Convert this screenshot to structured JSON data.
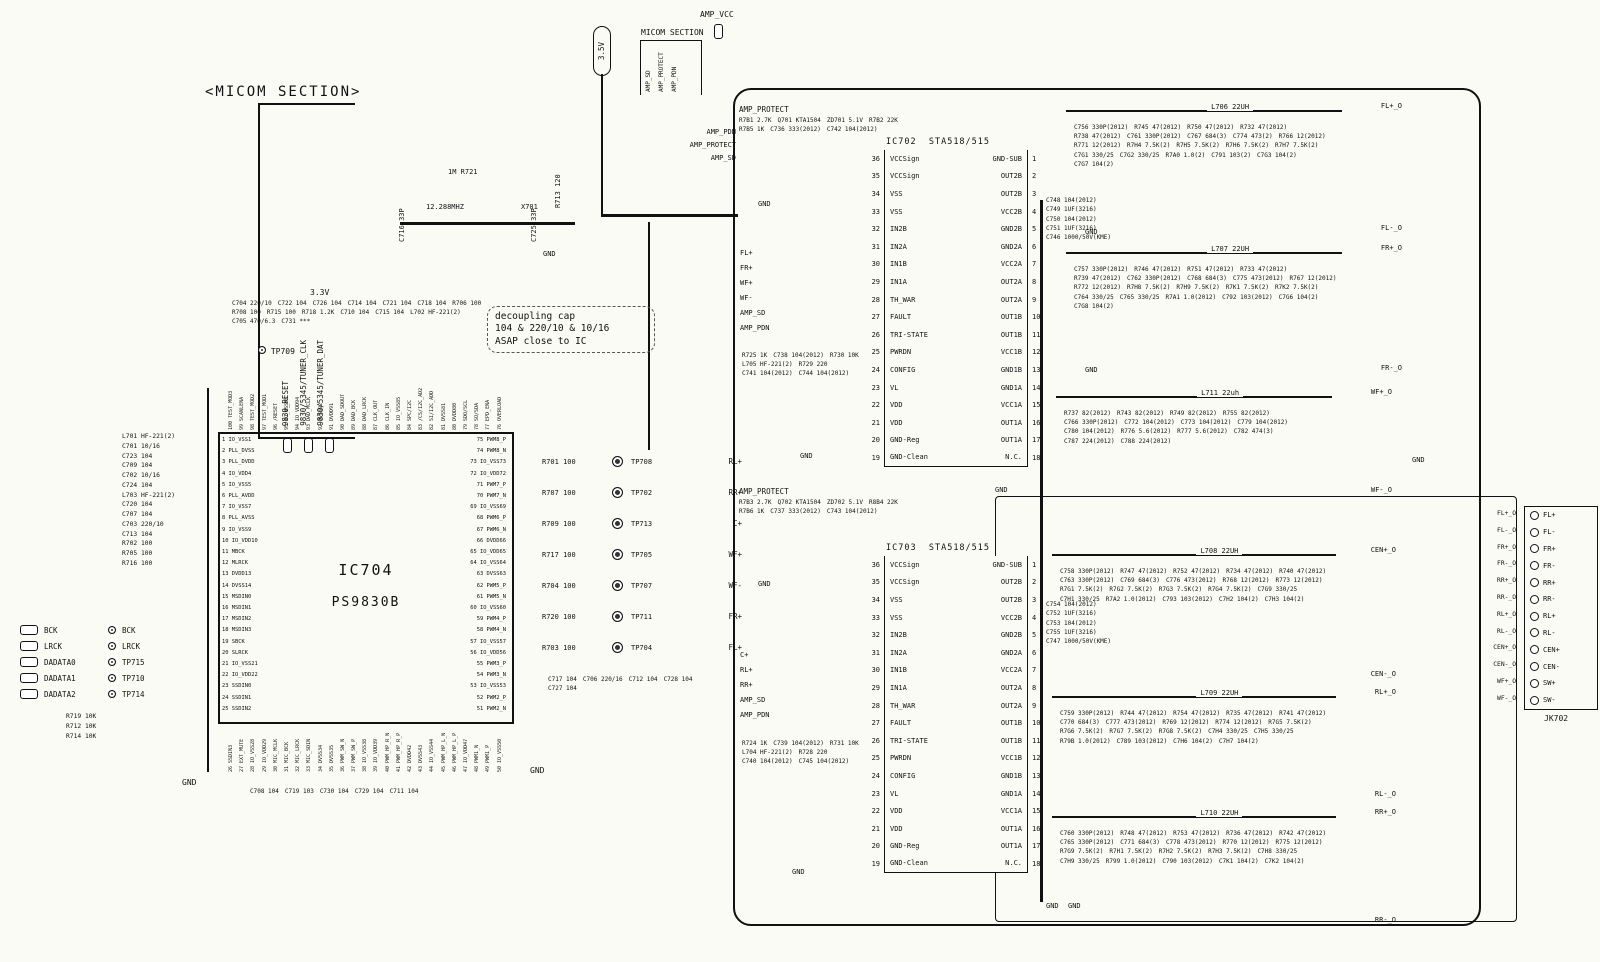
{
  "labels": {
    "gnd": "GND",
    "v35": "3.5V",
    "v33": "3.3V",
    "amp_vcc": "AMP_VCC",
    "tp709": "TP709"
  },
  "micom_section": {
    "title": "<MICOM SECTION>",
    "signals": [
      "9830_RESET",
      "9830/5345/TUNER_CLK",
      "9830/5345/TUNER_DAT"
    ]
  },
  "micom2": {
    "title": "MICOM SECTION",
    "signals": [
      "AMP_SD",
      "AMP_PROTECT",
      "AMP_PDN"
    ]
  },
  "amp_entry": [
    "AMP_PDN",
    "AMP_PROTECT",
    "AMP_SD"
  ],
  "crystal": {
    "r721": "1M R721",
    "freq": "12.288MHZ",
    "x701": "X701",
    "c716": "C716 33P",
    "c725": "C725 33P",
    "r713": "R713 120",
    "gnd": "GND"
  },
  "note": {
    "lines": [
      "decoupling cap",
      "104 & 220/10 & 10/16",
      "ASAP close to IC"
    ]
  },
  "ic704": {
    "ref": "IC704",
    "part": "PS9830B",
    "left": [
      "1 IO_VSS1",
      "2 PLL_DVSS",
      "3 PLL_DVDD",
      "4 IO_VDD4",
      "5 IO_VSS5",
      "6 PLL_AVDD",
      "7 IO_VSS7",
      "8 PLL_AVSS",
      "9 IO_VSS9",
      "10 IO_VDD10",
      "11 MBCK",
      "12 MLRCK",
      "13 DVDD13",
      "14 DVSS14",
      "15 MSDIN0",
      "16 MSDIN1",
      "17 MSDIN2",
      "18 MSDIN3",
      "19 SBCK",
      "20 SLRCK",
      "21 IO_VSS21",
      "22 IO_VDD22",
      "23 SSDIN0",
      "24 SSDIN1",
      "25 SSDIN2"
    ],
    "right": [
      "75 PWM8_P",
      "74 PWM8_N",
      "73 IO_VSS73",
      "72 IO_VDD72",
      "71 PWM7_P",
      "70 PWM7_N",
      "69 IO_VSS69",
      "68 PWM6_P",
      "67 PWM6_N",
      "66 DVDD66",
      "65 IO_VDD65",
      "64 IO_VSS64",
      "63 DVSS63",
      "62 PWM5_P",
      "61 PWM5_N",
      "60 IO_VSS60",
      "59 PWM4_P",
      "58 PWM4_N",
      "57 IO_VSS57",
      "56 IO_VDD56",
      "55 PWM3_P",
      "54 PWM3_N",
      "53 IO_VSS53",
      "52 PWM2_P",
      "51 PWM2_N"
    ],
    "top": [
      "100 TEST_MOD3",
      "99 SCANLENA",
      "98 TEST_MOD2",
      "97 TEST_MOD1",
      "96 /RESET",
      "95 IO_VSS95",
      "94 IO_VDD94",
      "93 DAD_MCLK",
      "92 DVSS92",
      "91 DVDD91",
      "90 DAD_SDOUT",
      "89 DAD_BCK",
      "88 DAD_LRCK",
      "87 CLK_OUT",
      "86 CLK_IN",
      "85 IO_VSS85",
      "84 SPC/I2C",
      "83 /CS/I2C_AD2",
      "82 SI/I2C_ADD",
      "81 DVSS81",
      "80 DVDD80",
      "79 SDO/SCL",
      "78 SO/SDA",
      "77 EPD_ENA",
      "76 OVERLOAD"
    ],
    "bottom": [
      "26 SSDIN3",
      "27 EXT_MUTE",
      "28 IO_VSS28",
      "29 IO_VDD29",
      "30 MIC_MCLK",
      "31 MIC_BCK",
      "32 MIC_LRCK",
      "33 MIC_SDIN",
      "34 DVSS34",
      "35 DVSS35",
      "36 PWM_SW_N",
      "37 PWM_SW_P",
      "38 IO_VSS38",
      "39 IO_VDD39",
      "40 PWM_HP_R_N",
      "41 PWM_HP_R_P",
      "42 DVDD42",
      "43 DVSS43",
      "44 IO_VSS44",
      "45 PWM_HP_L_N",
      "46 PWM_HP_L_P",
      "47 IO_VDD47",
      "48 PWM1_N",
      "49 PWM1_P",
      "50 IO_VSS50"
    ],
    "left_parts": [
      "L701 HF-221(2)",
      "C701 10/16",
      "C723 104",
      "C709 104",
      "C702 10/16",
      "C724 104",
      "L703 HF-221(2)",
      "C720 104",
      "C707 104",
      "C703 220/10",
      "C713 104",
      "R702 100",
      "R705 100",
      "R716 100"
    ],
    "top_parts": [
      "C704 220/10",
      "C722 104",
      "C726 104",
      "C714 104",
      "C721 104",
      "C718 104",
      "R706 100",
      "R708 100",
      "R715 100",
      "R718 1.2K",
      "C710 104",
      "C715 104",
      "L702 HF-221(2)",
      "C705 470/6.3",
      "C731 ***"
    ],
    "bottom_parts": [
      "C708 104",
      "C719 103",
      "C730 104",
      "C729 104",
      "C711 104"
    ]
  },
  "conn_left": {
    "rows": [
      {
        "pad": "BCK",
        "tp": "BCK"
      },
      {
        "pad": "LRCK",
        "tp": "LRCK"
      },
      {
        "pad": "DADATA0",
        "tp": "TP715"
      },
      {
        "pad": "DADATA1",
        "tp": "TP710"
      },
      {
        "pad": "DADATA2",
        "tp": "TP714"
      }
    ],
    "pulls": [
      "R719 10K",
      "R712 10K",
      "R714 10K"
    ]
  },
  "tp": {
    "rows": [
      {
        "res": "R701 100",
        "tp": "TP708",
        "sig": "RL+"
      },
      {
        "res": "R707 100",
        "tp": "TP702",
        "sig": "RR+"
      },
      {
        "res": "R709 100",
        "tp": "TP713",
        "sig": "C+"
      },
      {
        "res": "R717 100",
        "tp": "TP705",
        "sig": "WF+"
      },
      {
        "res": "R704 100",
        "tp": "TP707",
        "sig": "WF-"
      },
      {
        "res": "R720 100",
        "tp": "TP711",
        "sig": "FR+"
      },
      {
        "res": "R703 100",
        "tp": "TP704",
        "sig": "FL+"
      }
    ],
    "caps": [
      "C717 104",
      "C706 220/16",
      "C712 104",
      "C728 104",
      "C727 104"
    ]
  },
  "prot1": {
    "entry": "AMP_PROTECT",
    "parts": [
      "R7B1 2.7K",
      "Q701 KTA1504",
      "ZD701 5.1V",
      "R7B2 22K",
      "R7B5 1K",
      "C736 333(2012)",
      "C742 104(2012)"
    ]
  },
  "prot2": {
    "entry": "AMP_PROTECT",
    "parts": [
      "R7B3 2.7K",
      "Q702 KTA1504",
      "ZD702 5.1V",
      "R8B4 22K",
      "R7B6 1K",
      "C737 333(2012)",
      "C743 104(2012)"
    ]
  },
  "ic702": {
    "ref": "IC702",
    "part": "STA518/515",
    "rows": [
      {
        "nl": 36,
        "ll": "VCCSign",
        "lr": "GND-SUB",
        "nr": 1
      },
      {
        "nl": 35,
        "ll": "VCCSign",
        "lr": "OUT2B",
        "nr": 2
      },
      {
        "nl": 34,
        "ll": "VSS",
        "lr": "OUT2B",
        "nr": 3
      },
      {
        "nl": 33,
        "ll": "VSS",
        "lr": "VCC2B",
        "nr": 4
      },
      {
        "nl": 32,
        "ll": "IN2B",
        "lr": "GND2B",
        "nr": 5
      },
      {
        "nl": 31,
        "ll": "IN2A",
        "lr": "GND2A",
        "nr": 6
      },
      {
        "nl": 30,
        "ll": "IN1B",
        "lr": "VCC2A",
        "nr": 7
      },
      {
        "nl": 29,
        "ll": "IN1A",
        "lr": "OUT2A",
        "nr": 8
      },
      {
        "nl": 28,
        "ll": "TH_WAR",
        "lr": "OUT2A",
        "nr": 9
      },
      {
        "nl": 27,
        "ll": "FAULT",
        "lr": "OUT1B",
        "nr": 10
      },
      {
        "nl": 26,
        "ll": "TRI-STATE",
        "lr": "OUT1B",
        "nr": 11
      },
      {
        "nl": 25,
        "ll": "PWRDN",
        "lr": "VCC1B",
        "nr": 12
      },
      {
        "nl": 24,
        "ll": "CONFIG",
        "lr": "GND1B",
        "nr": 13
      },
      {
        "nl": 23,
        "ll": "VL",
        "lr": "GND1A",
        "nr": 14
      },
      {
        "nl": 22,
        "ll": "VDD",
        "lr": "VCC1A",
        "nr": 15
      },
      {
        "nl": 21,
        "ll": "VDD",
        "lr": "OUT1A",
        "nr": 16
      },
      {
        "nl": 20,
        "ll": "GND-Reg",
        "lr": "OUT1A",
        "nr": 17
      },
      {
        "nl": 19,
        "ll": "GND-Clean",
        "lr": "N.C.",
        "nr": 18
      }
    ],
    "caps": [
      "C748 104(2012)",
      "C749 1UF(3216)",
      "C750 104(2012)",
      "C751 1UF(3216)",
      "C746 1000/50V(KME)"
    ]
  },
  "ic703": {
    "ref": "IC703",
    "part": "STA518/515",
    "rows": [
      {
        "nl": 36,
        "ll": "VCCSign",
        "lr": "GND-SUB",
        "nr": 1
      },
      {
        "nl": 35,
        "ll": "VCCSign",
        "lr": "OUT2B",
        "nr": 2
      },
      {
        "nl": 34,
        "ll": "VSS",
        "lr": "OUT2B",
        "nr": 3
      },
      {
        "nl": 33,
        "ll": "VSS",
        "lr": "VCC2B",
        "nr": 4
      },
      {
        "nl": 32,
        "ll": "IN2B",
        "lr": "GND2B",
        "nr": 5
      },
      {
        "nl": 31,
        "ll": "IN2A",
        "lr": "GND2A",
        "nr": 6
      },
      {
        "nl": 30,
        "ll": "IN1B",
        "lr": "VCC2A",
        "nr": 7
      },
      {
        "nl": 29,
        "ll": "IN1A",
        "lr": "OUT2A",
        "nr": 8
      },
      {
        "nl": 28,
        "ll": "TH_WAR",
        "lr": "OUT2A",
        "nr": 9
      },
      {
        "nl": 27,
        "ll": "FAULT",
        "lr": "OUT1B",
        "nr": 10
      },
      {
        "nl": 26,
        "ll": "TRI-STATE",
        "lr": "OUT1B",
        "nr": 11
      },
      {
        "nl": 25,
        "ll": "PWRDN",
        "lr": "VCC1B",
        "nr": 12
      },
      {
        "nl": 24,
        "ll": "CONFIG",
        "lr": "GND1B",
        "nr": 13
      },
      {
        "nl": 23,
        "ll": "VL",
        "lr": "GND1A",
        "nr": 14
      },
      {
        "nl": 22,
        "ll": "VDD",
        "lr": "VCC1A",
        "nr": 15
      },
      {
        "nl": 21,
        "ll": "VDD",
        "lr": "OUT1A",
        "nr": 16
      },
      {
        "nl": 20,
        "ll": "GND-Reg",
        "lr": "OUT1A",
        "nr": 17
      },
      {
        "nl": 19,
        "ll": "GND-Clean",
        "lr": "N.C.",
        "nr": 18
      }
    ],
    "caps": [
      "C754 104(2012)",
      "C752 1UF(3216)",
      "C753 104(2012)",
      "C755 1UF(3216)",
      "C747 1000/50V(KME)"
    ]
  },
  "ic702_in": {
    "signals": [
      "FL+",
      "FR+",
      "WF+",
      "WF-",
      "AMP_SD",
      "AMP_PDN"
    ],
    "parts": [
      "R725 1K",
      "C738 104(2012)",
      "R730 10K",
      "L705 HF-221(2)",
      "R729 220",
      "C741 104(2012)",
      "C744 104(2012)"
    ]
  },
  "ic703_in": {
    "signals": [
      "C+",
      "RL+",
      "RR+",
      "AMP_SD",
      "AMP_PDN"
    ],
    "parts": [
      "R724 1K",
      "C739 104(2012)",
      "R731 10K",
      "L704 HF-221(2)",
      "R728 220",
      "C740 104(2012)",
      "C745 104(2012)"
    ]
  },
  "channels": {
    "fl": {
      "ind": "L706 22UH",
      "out_p": "FL+_O",
      "out_n": "FL-_O",
      "parts": [
        "C756 330P(2012)",
        "R745 47(2012)",
        "R750 47(2012)",
        "R732 47(2012)",
        "R738 47(2012)",
        "C761 330P(2012)",
        "C767 684(3)",
        "C774 473(2)",
        "R766 12(2012)",
        "R771 12(2012)",
        "R7H4 7.5K(2)",
        "R7H5 7.5K(2)",
        "R7H6 7.5K(2)",
        "R7H7 7.5K(2)",
        "C7G1 330/25",
        "C7G2 330/25",
        "R7A0 1.0(2)",
        "C791 103(2)",
        "C7G3 104(2)",
        "C7G7 104(2)"
      ]
    },
    "fr": {
      "ind": "L707 22UH",
      "out_p": "FR+_O",
      "out_n": "FR-_O",
      "parts": [
        "C757 330P(2012)",
        "R746 47(2012)",
        "R751 47(2012)",
        "R733 47(2012)",
        "R739 47(2012)",
        "C762 330P(2012)",
        "C768 684(3)",
        "C775 473(2012)",
        "R767 12(2012)",
        "R772 12(2012)",
        "R7H8 7.5K(2)",
        "R7H9 7.5K(2)",
        "R7K1 7.5K(2)",
        "R7K2 7.5K(2)",
        "C764 330/25",
        "C765 330/25",
        "R7A1 1.0(2012)",
        "C792 103(2012)",
        "C7G6 104(2)",
        "C7G8 104(2)"
      ]
    },
    "wf": {
      "ind": "L711 22uh",
      "out_p": "WF+_O",
      "out_n": "WF-_O",
      "parts": [
        "R737 82(2012)",
        "R743 82(2012)",
        "R749 82(2012)",
        "R755 82(2012)",
        "C766 330P(2012)",
        "C772 104(2012)",
        "C773 104(2012)",
        "C779 104(2012)",
        "C780 104(2012)",
        "R776 5.6(2012)",
        "R777 5.6(2012)",
        "C782 474(3)",
        "C787 224(2012)",
        "C788 224(2012)"
      ]
    },
    "cen": {
      "ind": "L708 22UH",
      "out_p": "CEN+_O",
      "out_n": "CEN-_O",
      "parts": [
        "C758 330P(2012)",
        "R747 47(2012)",
        "R752 47(2012)",
        "R734 47(2012)",
        "R740 47(2012)",
        "C763 330P(2012)",
        "C769 684(3)",
        "C776 473(2012)",
        "R768 12(2012)",
        "R773 12(2012)",
        "R7G1 7.5K(2)",
        "R7G2 7.5K(2)",
        "R7G3 7.5K(2)",
        "R7G4 7.5K(2)",
        "C7G9 330/25",
        "C7H1 330/25",
        "R7A2 1.0(2012)",
        "C793 103(2012)",
        "C7H2 104(2)",
        "C7H3 104(2)"
      ]
    },
    "rl": {
      "ind": "L709 22UH",
      "out_p": "RL+_O",
      "out_n": "RL-_O",
      "parts": [
        "C759 330P(2012)",
        "R744 47(2012)",
        "R754 47(2012)",
        "R735 47(2012)",
        "R741 47(2012)",
        "C770 684(3)",
        "C777 473(2012)",
        "R769 12(2012)",
        "R774 12(2012)",
        "R7G5 7.5K(2)",
        "R7G6 7.5K(2)",
        "R7G7 7.5K(2)",
        "R7G8 7.5K(2)",
        "C7H4 330/25",
        "C7H5 330/25",
        "R79B 1.0(2012)",
        "C789 103(2012)",
        "C7H6 104(2)",
        "C7H7 104(2)"
      ]
    },
    "rr": {
      "ind": "L710 22UH",
      "out_p": "RR+_O",
      "out_n": "RR-_O",
      "parts": [
        "C760 330P(2012)",
        "R748 47(2012)",
        "R753 47(2012)",
        "R736 47(2012)",
        "R742 47(2012)",
        "C765 330P(2012)",
        "C771 684(3)",
        "C778 473(2012)",
        "R770 12(2012)",
        "R775 12(2012)",
        "R7G9 7.5K(2)",
        "R7H1 7.5K(2)",
        "R7H2 7.5K(2)",
        "R7H3 7.5K(2)",
        "C7H8 330/25",
        "C7H9 330/25",
        "R799 1.0(2012)",
        "C790 103(2012)",
        "C7K1 104(2)",
        "C7K2 104(2)"
      ]
    }
  },
  "jk702": {
    "ref": "JK702",
    "rows": [
      {
        "w": "FL+_O",
        "p": "FL+"
      },
      {
        "w": "FL-_O",
        "p": "FL-"
      },
      {
        "w": "FR+_O",
        "p": "FR+"
      },
      {
        "w": "FR-_O",
        "p": "FR-"
      },
      {
        "w": "RR+_O",
        "p": "RR+"
      },
      {
        "w": "RR-_O",
        "p": "RR-"
      },
      {
        "w": "RL+_O",
        "p": "RL+"
      },
      {
        "w": "RL-_O",
        "p": "RL-"
      },
      {
        "w": "CEN+_O",
        "p": "CEN+"
      },
      {
        "w": "CEN-_O",
        "p": "CEN-"
      },
      {
        "w": "WF+_O",
        "p": "SW+"
      },
      {
        "w": "WF-_O",
        "p": "SW-"
      }
    ]
  }
}
